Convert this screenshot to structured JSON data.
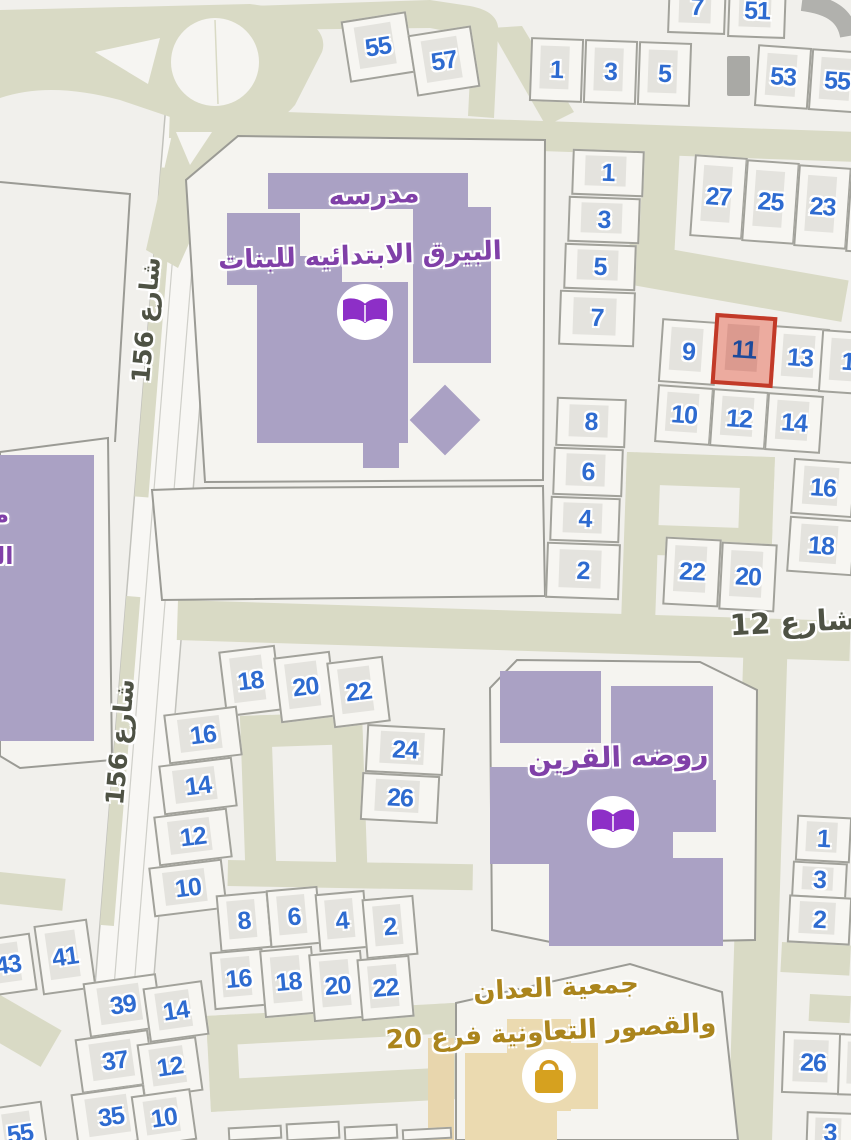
{
  "streets": [
    {
      "name": "شارع 156",
      "instance": "upper"
    },
    {
      "name": "شارع 156",
      "instance": "lower"
    },
    {
      "name": "شارع 12",
      "instance": "main"
    }
  ],
  "pois": {
    "girls_school": {
      "line1": "مدرسه",
      "line2": "البيرق الابتدائيه للبنات",
      "icon": "open-book"
    },
    "left_school_partial": {
      "line1": "مـ",
      "line2": "الـ"
    },
    "kindergarten": {
      "name": "روضه القرين",
      "icon": "open-book"
    },
    "coop": {
      "line1": "جمعية العدان",
      "line2": "والقصور التعاونية فرع 20",
      "icon": "shopping-bag"
    }
  },
  "selected_plot": "11",
  "colors": {
    "road": "#d9dac5",
    "plot_number": "#2e6bd0",
    "selected_fill": "#ecab9f",
    "selected_border": "#c23a28",
    "selected_number": "#1d4a9a",
    "school_building": "#aaa1c4",
    "poi_text": "#8040a8",
    "gold_text": "#ab851d",
    "street_text": "#4e5244",
    "coop_building": "#ebdab0"
  },
  "plots": [
    {
      "n": "55",
      "x": 345,
      "y": 16,
      "w": 66,
      "h": 62,
      "r": -9
    },
    {
      "n": "57",
      "x": 412,
      "y": 30,
      "w": 64,
      "h": 62,
      "r": -9
    },
    {
      "n": "1",
      "x": 530,
      "y": 38,
      "w": 53,
      "h": 64,
      "r": 2
    },
    {
      "n": "3",
      "x": 584,
      "y": 40,
      "w": 53,
      "h": 64,
      "r": 2
    },
    {
      "n": "5",
      "x": 638,
      "y": 42,
      "w": 53,
      "h": 64,
      "r": 2
    },
    {
      "n": "7",
      "x": 668,
      "y": -20,
      "w": 58,
      "h": 54,
      "r": 2
    },
    {
      "n": "51",
      "x": 728,
      "y": -16,
      "w": 58,
      "h": 54,
      "r": 2
    },
    {
      "n": "53",
      "x": 756,
      "y": 46,
      "w": 54,
      "h": 62,
      "r": 4
    },
    {
      "n": "55",
      "x": 810,
      "y": 50,
      "w": 54,
      "h": 62,
      "r": 4
    },
    {
      "n": "27",
      "x": 692,
      "y": 156,
      "w": 53,
      "h": 82,
      "r": 4
    },
    {
      "n": "25",
      "x": 744,
      "y": 161,
      "w": 53,
      "h": 82,
      "r": 4
    },
    {
      "n": "23",
      "x": 796,
      "y": 166,
      "w": 53,
      "h": 82,
      "r": 4
    },
    {
      "n": "",
      "x": 848,
      "y": 171,
      "w": 34,
      "h": 82,
      "r": 4
    },
    {
      "n": "1",
      "x": 572,
      "y": 150,
      "w": 72,
      "h": 46,
      "r": 2
    },
    {
      "n": "3",
      "x": 568,
      "y": 197,
      "w": 72,
      "h": 46,
      "r": 2
    },
    {
      "n": "5",
      "x": 564,
      "y": 244,
      "w": 72,
      "h": 46,
      "r": 2
    },
    {
      "n": "7",
      "x": 559,
      "y": 291,
      "w": 76,
      "h": 55,
      "r": 2
    },
    {
      "n": "8",
      "x": 556,
      "y": 398,
      "w": 70,
      "h": 49,
      "r": 2
    },
    {
      "n": "6",
      "x": 553,
      "y": 448,
      "w": 70,
      "h": 48,
      "r": 2
    },
    {
      "n": "4",
      "x": 550,
      "y": 497,
      "w": 70,
      "h": 45,
      "r": 2
    },
    {
      "n": "2",
      "x": 546,
      "y": 543,
      "w": 74,
      "h": 56,
      "r": 2
    },
    {
      "n": "9",
      "x": 660,
      "y": 320,
      "w": 57,
      "h": 64,
      "r": 4
    },
    {
      "n": "11",
      "x": 713,
      "y": 315,
      "w": 62,
      "h": 71,
      "r": 4,
      "selected": true
    },
    {
      "n": "13",
      "x": 772,
      "y": 327,
      "w": 56,
      "h": 63,
      "r": 4
    },
    {
      "n": "1",
      "x": 820,
      "y": 331,
      "w": 56,
      "h": 63,
      "r": 4
    },
    {
      "n": "10",
      "x": 656,
      "y": 386,
      "w": 56,
      "h": 58,
      "r": 4
    },
    {
      "n": "12",
      "x": 711,
      "y": 390,
      "w": 56,
      "h": 58,
      "r": 4
    },
    {
      "n": "14",
      "x": 766,
      "y": 394,
      "w": 56,
      "h": 58,
      "r": 4
    },
    {
      "n": "16",
      "x": 792,
      "y": 460,
      "w": 62,
      "h": 56,
      "r": 4
    },
    {
      "n": "18",
      "x": 788,
      "y": 518,
      "w": 66,
      "h": 56,
      "r": 4
    },
    {
      "n": "22",
      "x": 664,
      "y": 538,
      "w": 56,
      "h": 68,
      "r": 3
    },
    {
      "n": "20",
      "x": 720,
      "y": 543,
      "w": 56,
      "h": 68,
      "r": 3
    },
    {
      "n": "18",
      "x": 222,
      "y": 648,
      "w": 57,
      "h": 66,
      "r": -7
    },
    {
      "n": "20",
      "x": 277,
      "y": 654,
      "w": 57,
      "h": 66,
      "r": -7
    },
    {
      "n": "22",
      "x": 330,
      "y": 659,
      "w": 57,
      "h": 66,
      "r": -7
    },
    {
      "n": "16",
      "x": 166,
      "y": 710,
      "w": 74,
      "h": 50,
      "r": -7
    },
    {
      "n": "14",
      "x": 161,
      "y": 761,
      "w": 74,
      "h": 50,
      "r": -7
    },
    {
      "n": "12",
      "x": 156,
      "y": 812,
      "w": 74,
      "h": 50,
      "r": -7
    },
    {
      "n": "10",
      "x": 151,
      "y": 863,
      "w": 74,
      "h": 50,
      "r": -7
    },
    {
      "n": "24",
      "x": 366,
      "y": 726,
      "w": 78,
      "h": 48,
      "r": 3
    },
    {
      "n": "26",
      "x": 361,
      "y": 774,
      "w": 78,
      "h": 48,
      "r": 3
    },
    {
      "n": "43",
      "x": -18,
      "y": 936,
      "w": 52,
      "h": 58,
      "r": -8
    },
    {
      "n": "41",
      "x": 38,
      "y": 922,
      "w": 54,
      "h": 70,
      "r": -8
    },
    {
      "n": "39",
      "x": 86,
      "y": 978,
      "w": 74,
      "h": 55,
      "r": -8
    },
    {
      "n": "14",
      "x": 146,
      "y": 984,
      "w": 60,
      "h": 55,
      "r": -8
    },
    {
      "n": "37",
      "x": 78,
      "y": 1034,
      "w": 74,
      "h": 55,
      "r": -8
    },
    {
      "n": "12",
      "x": 140,
      "y": 1040,
      "w": 60,
      "h": 55,
      "r": -8
    },
    {
      "n": "35",
      "x": 74,
      "y": 1089,
      "w": 74,
      "h": 56,
      "r": -8
    },
    {
      "n": "10",
      "x": 134,
      "y": 1092,
      "w": 60,
      "h": 52,
      "r": -8
    },
    {
      "n": "55",
      "x": -6,
      "y": 1104,
      "w": 52,
      "h": 60,
      "r": -8
    },
    {
      "n": "8",
      "x": 218,
      "y": 893,
      "w": 52,
      "h": 57,
      "r": -5
    },
    {
      "n": "6",
      "x": 268,
      "y": 888,
      "w": 52,
      "h": 58,
      "r": -5
    },
    {
      "n": "4",
      "x": 317,
      "y": 892,
      "w": 50,
      "h": 58,
      "r": -5
    },
    {
      "n": "2",
      "x": 364,
      "y": 897,
      "w": 52,
      "h": 60,
      "r": -5
    },
    {
      "n": "16",
      "x": 212,
      "y": 950,
      "w": 53,
      "h": 58,
      "r": -5
    },
    {
      "n": "18",
      "x": 262,
      "y": 948,
      "w": 53,
      "h": 68,
      "r": -5
    },
    {
      "n": "20",
      "x": 311,
      "y": 952,
      "w": 53,
      "h": 68,
      "r": -5
    },
    {
      "n": "22",
      "x": 359,
      "y": 957,
      "w": 53,
      "h": 62,
      "r": -5
    },
    {
      "n": "",
      "x": 228,
      "y": 1126,
      "w": 54,
      "h": 14,
      "r": -3
    },
    {
      "n": "",
      "x": 286,
      "y": 1122,
      "w": 54,
      "h": 18,
      "r": -3
    },
    {
      "n": "",
      "x": 344,
      "y": 1125,
      "w": 54,
      "h": 15,
      "r": -3
    },
    {
      "n": "",
      "x": 402,
      "y": 1128,
      "w": 50,
      "h": 12,
      "r": -3
    },
    {
      "n": "1",
      "x": 796,
      "y": 816,
      "w": 55,
      "h": 46,
      "r": 3
    },
    {
      "n": "3",
      "x": 792,
      "y": 862,
      "w": 55,
      "h": 36,
      "r": 3
    },
    {
      "n": "2",
      "x": 788,
      "y": 896,
      "w": 63,
      "h": 48,
      "r": 3
    },
    {
      "n": "26",
      "x": 782,
      "y": 1032,
      "w": 62,
      "h": 62,
      "r": 2
    },
    {
      "n": "2",
      "x": 838,
      "y": 1034,
      "w": 45,
      "h": 62,
      "r": 2
    },
    {
      "n": "3",
      "x": 806,
      "y": 1112,
      "w": 48,
      "h": 42,
      "r": 2
    }
  ]
}
